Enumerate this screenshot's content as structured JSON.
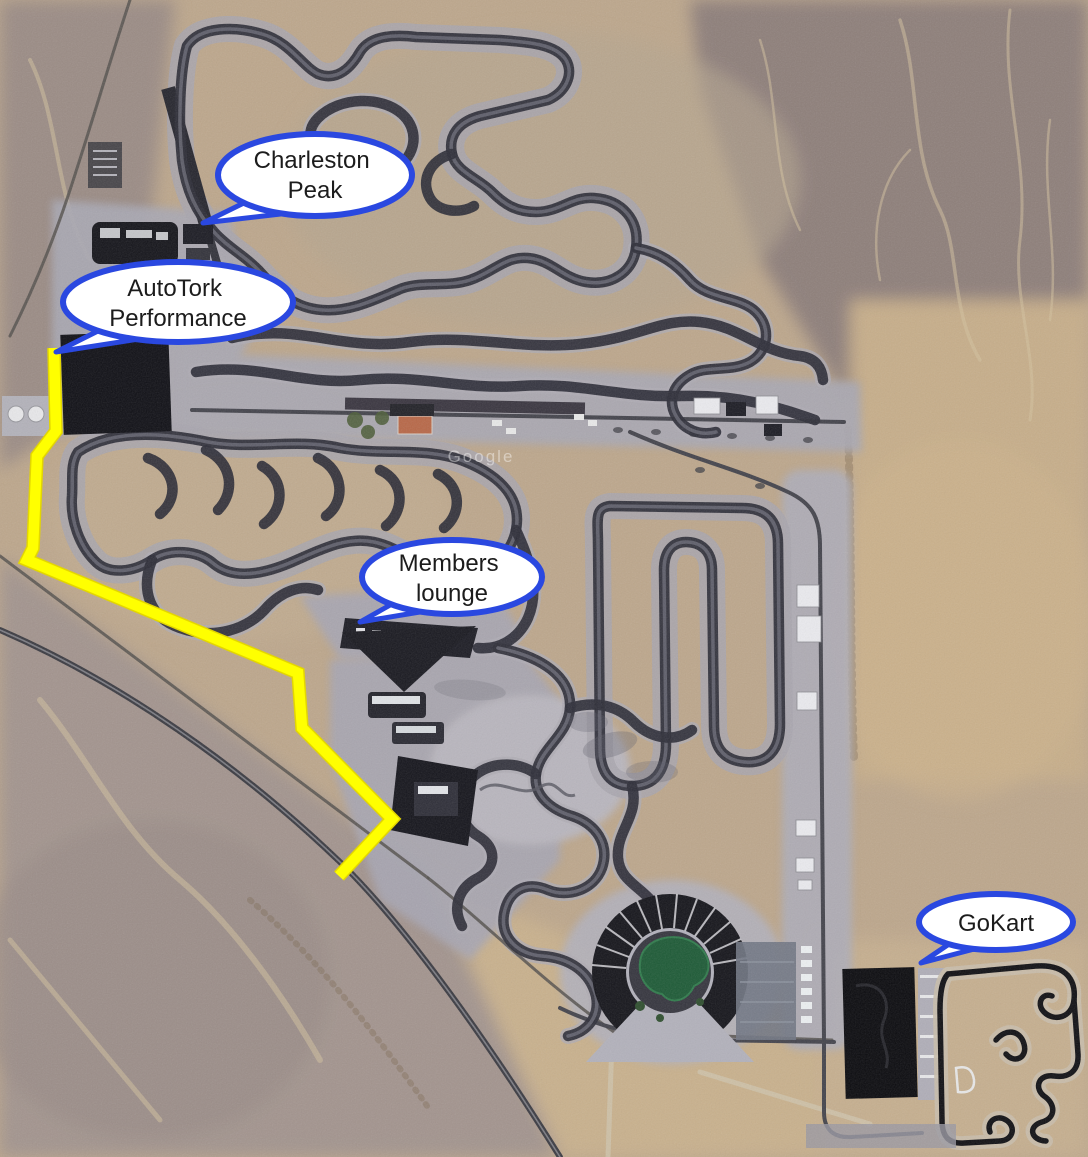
{
  "map": {
    "watermark": "Google",
    "colors": {
      "route": "#ffff00",
      "route_edge": "#e3d600",
      "bubble_border": "#2a48e0",
      "bubble_fill": "#ffffff",
      "bubble_text": "#1c1c1c"
    },
    "route": {
      "points": "54,348 56,431 37,456 33,548 27,560 298,673 302,728 392,819 339,876",
      "width": 11
    },
    "callouts": [
      {
        "id": "charleston-peak",
        "line1": "Charleston",
        "line2": "Peak"
      },
      {
        "id": "autotork-performance",
        "line1": "AutoTork",
        "line2": "Performance"
      },
      {
        "id": "members-lounge",
        "line1": "Members",
        "line2": "lounge"
      },
      {
        "id": "gokart",
        "line1": "GoKart",
        "line2": ""
      }
    ]
  }
}
